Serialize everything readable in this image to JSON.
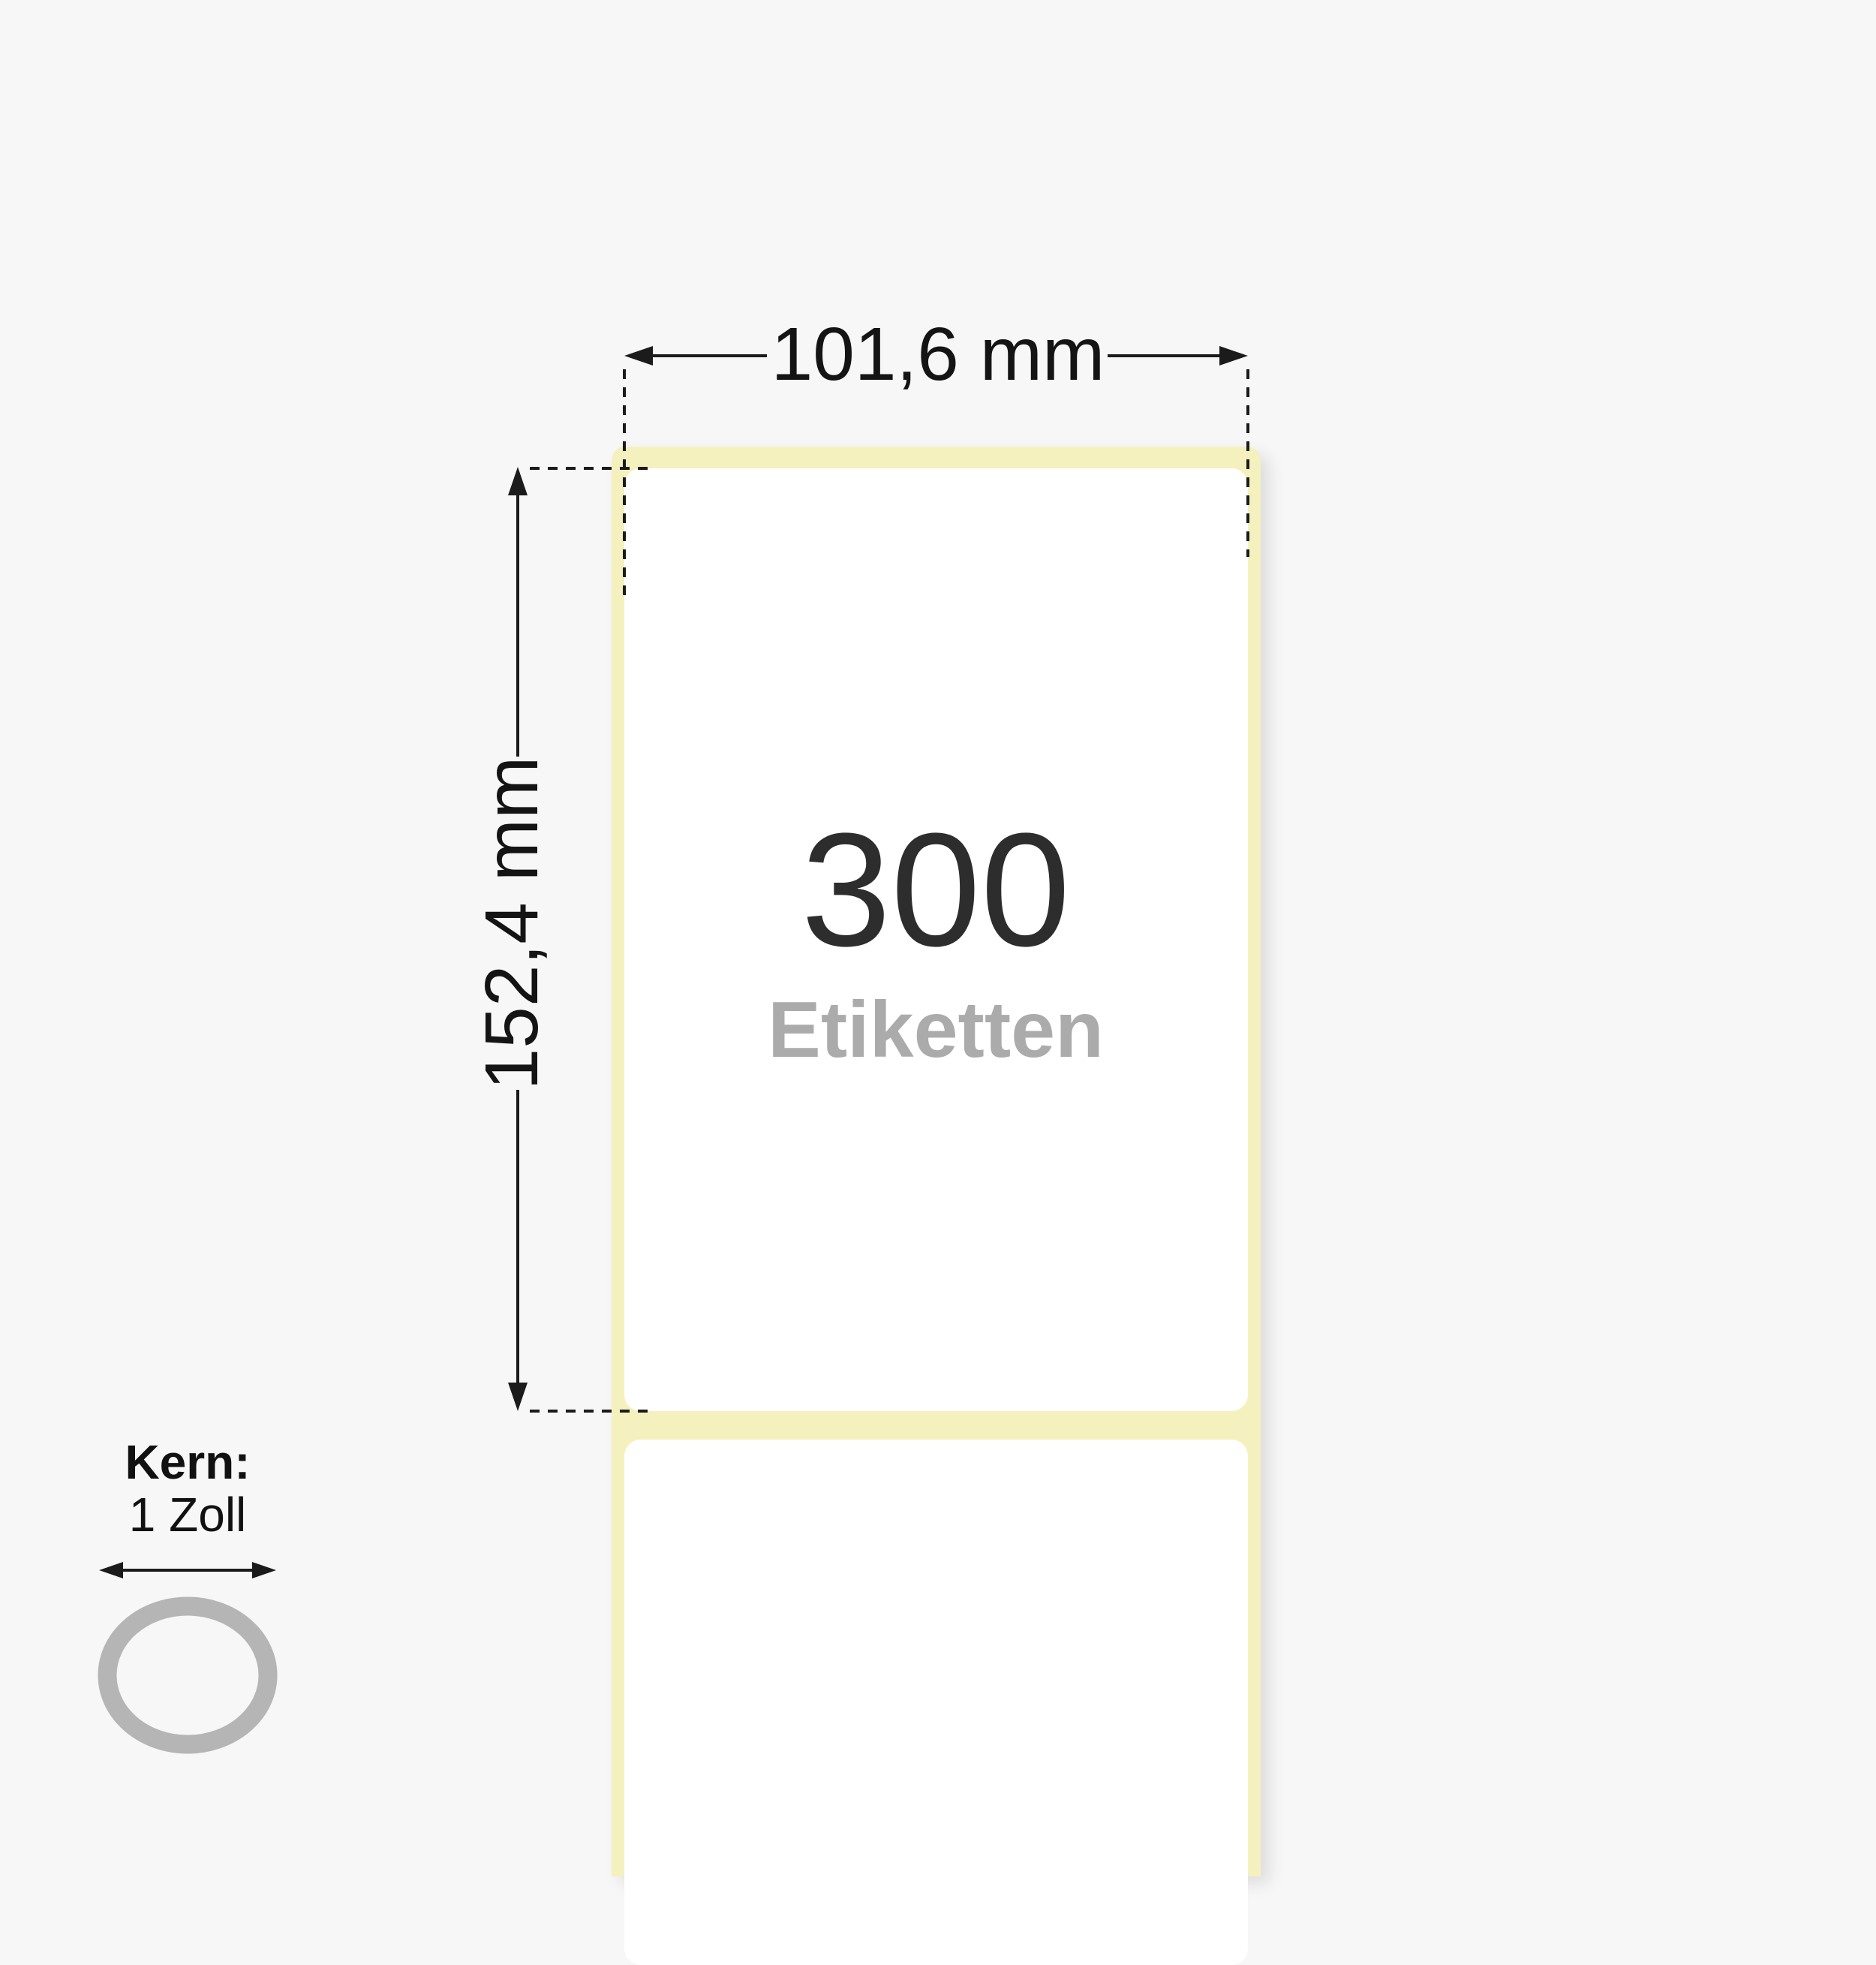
{
  "diagram": {
    "width_dimension": {
      "label": "101,6 mm"
    },
    "height_dimension": {
      "label": "152,4 mm"
    },
    "roll": {
      "count": "300",
      "unit": "Etiketten"
    },
    "core": {
      "title": "Kern:",
      "size": "1 Zoll"
    },
    "colors": {
      "background": "#F7F7F7",
      "liner_yellow": "#F5F1BE",
      "label_white": "#FFFFFF",
      "dimension_line": "#1B1B1B",
      "count_text": "#2D2D2D",
      "unit_text": "#ABABAB",
      "core_ring_gray": "#B5B5B5"
    }
  }
}
